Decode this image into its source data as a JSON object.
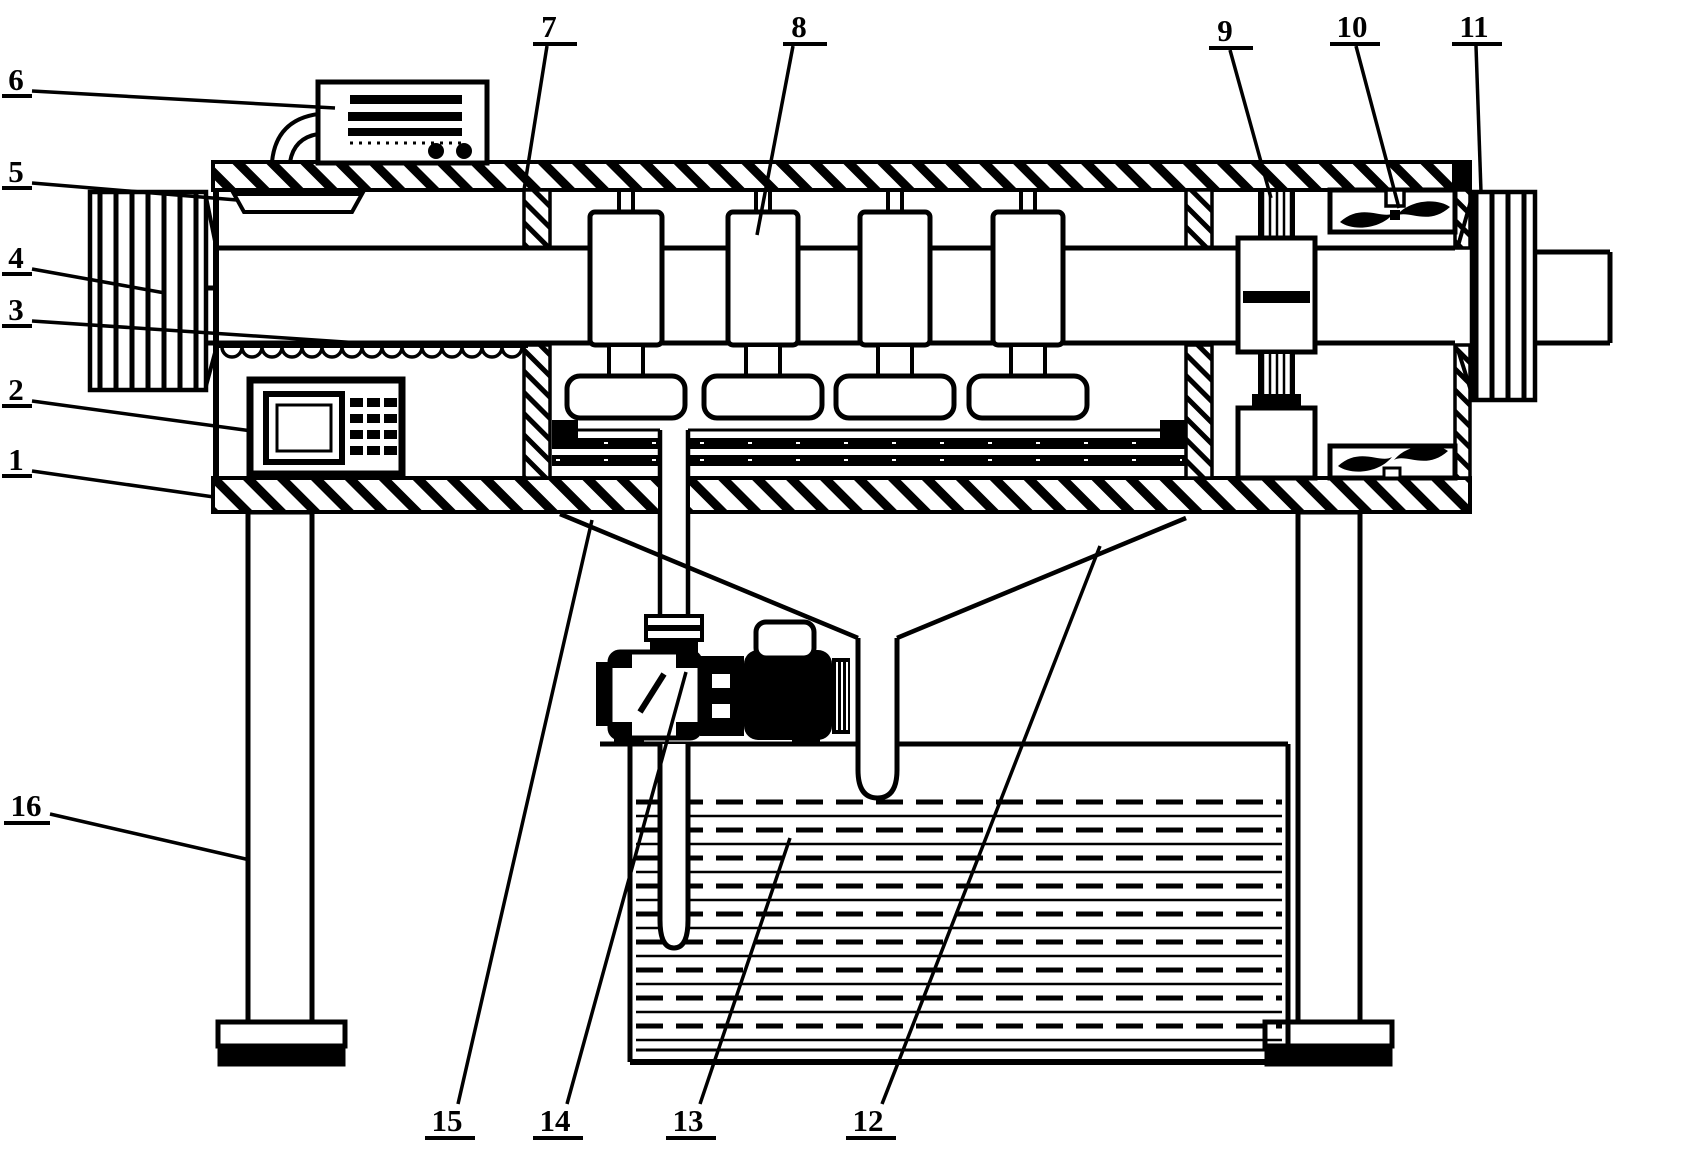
{
  "figure": {
    "background": "#ffffff",
    "ink": "#000000",
    "type": "patent-line-drawing"
  },
  "labels": [
    {
      "text": "1",
      "tx": 16,
      "ty": 459,
      "ux1": 2,
      "ux2": 32,
      "uy": 476,
      "lx1": 32,
      "ly1": 471,
      "lx2": 214,
      "ly2": 497
    },
    {
      "text": "2",
      "tx": 16,
      "ty": 389,
      "ux1": 2,
      "ux2": 32,
      "uy": 406,
      "lx1": 32,
      "ly1": 401,
      "lx2": 252,
      "ly2": 431
    },
    {
      "text": "3",
      "tx": 16,
      "ty": 309,
      "ux1": 2,
      "ux2": 32,
      "uy": 326,
      "lx1": 32,
      "ly1": 321,
      "lx2": 390,
      "ly2": 345
    },
    {
      "text": "4",
      "tx": 16,
      "ty": 257,
      "ux1": 2,
      "ux2": 32,
      "uy": 274,
      "lx1": 32,
      "ly1": 269,
      "lx2": 165,
      "ly2": 293
    },
    {
      "text": "5",
      "tx": 16,
      "ty": 171,
      "ux1": 2,
      "ux2": 32,
      "uy": 188,
      "lx1": 32,
      "ly1": 183,
      "lx2": 237,
      "ly2": 200
    },
    {
      "text": "6",
      "tx": 16,
      "ty": 79,
      "ux1": 2,
      "ux2": 32,
      "uy": 96,
      "lx1": 32,
      "ly1": 91,
      "lx2": 335,
      "ly2": 108
    },
    {
      "text": "7",
      "tx": 549,
      "ty": 26,
      "ux1": 533,
      "ux2": 577,
      "uy": 44,
      "lx1": 547,
      "ly1": 46,
      "lx2": 524,
      "ly2": 190
    },
    {
      "text": "8",
      "tx": 799,
      "ty": 26,
      "ux1": 783,
      "ux2": 827,
      "uy": 44,
      "lx1": 793,
      "ly1": 46,
      "lx2": 757,
      "ly2": 235
    },
    {
      "text": "9",
      "tx": 1225,
      "ty": 30,
      "ux1": 1209,
      "ux2": 1253,
      "uy": 48,
      "lx1": 1230,
      "ly1": 50,
      "lx2": 1271,
      "ly2": 198
    },
    {
      "text": "10",
      "tx": 1352,
      "ty": 26,
      "ux1": 1330,
      "ux2": 1380,
      "uy": 44,
      "lx1": 1356,
      "ly1": 46,
      "lx2": 1399,
      "ly2": 208
    },
    {
      "text": "11",
      "tx": 1474,
      "ty": 26,
      "ux1": 1452,
      "ux2": 1502,
      "uy": 44,
      "lx1": 1476,
      "ly1": 46,
      "lx2": 1481,
      "ly2": 192
    },
    {
      "text": "12",
      "tx": 868,
      "ty": 1120,
      "ux1": 846,
      "ux2": 896,
      "uy": 1138,
      "lx1": 882,
      "ly1": 1104,
      "lx2": 1100,
      "ly2": 546
    },
    {
      "text": "13",
      "tx": 688,
      "ty": 1120,
      "ux1": 666,
      "ux2": 716,
      "uy": 1138,
      "lx1": 700,
      "ly1": 1104,
      "lx2": 790,
      "ly2": 838
    },
    {
      "text": "14",
      "tx": 555,
      "ty": 1120,
      "ux1": 533,
      "ux2": 583,
      "uy": 1138,
      "lx1": 567,
      "ly1": 1104,
      "lx2": 686,
      "ly2": 672
    },
    {
      "text": "15",
      "tx": 447,
      "ty": 1120,
      "ux1": 425,
      "ux2": 475,
      "uy": 1138,
      "lx1": 458,
      "ly1": 1104,
      "lx2": 592,
      "ly2": 520
    },
    {
      "text": "16",
      "tx": 26,
      "ty": 805,
      "ux1": 4,
      "ux2": 50,
      "uy": 823,
      "lx1": 50,
      "ly1": 814,
      "lx2": 250,
      "ly2": 860
    }
  ],
  "water": {
    "x1": 636,
    "x2": 1282,
    "yTop": 802,
    "yBottom": 1042,
    "rowStep": 14
  },
  "scallops": {
    "x1": 222,
    "x2": 522,
    "y": 347,
    "radius": 10
  }
}
